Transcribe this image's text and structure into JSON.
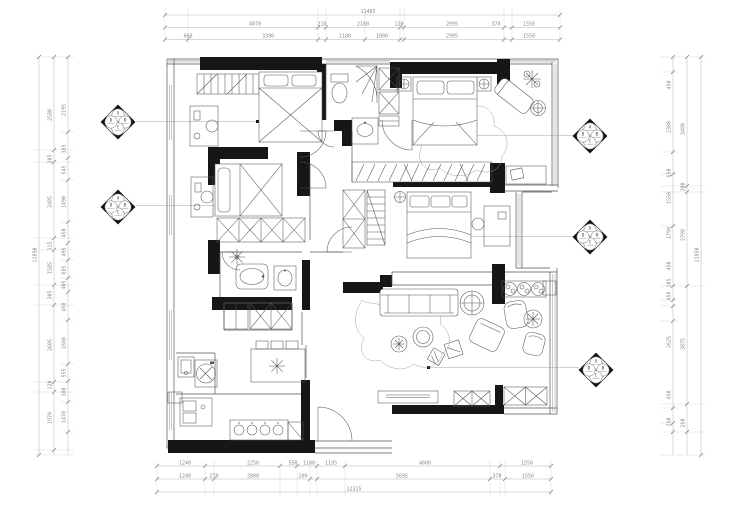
{
  "title": "apartment-floor-plan",
  "colors": {
    "wall": "#161616",
    "furniture_line": "#555555",
    "dim_text": "#8a8a8a",
    "dim_line": "#b5b5b5",
    "background": "#ffffff"
  },
  "dims": {
    "top_total": "11485",
    "top2": [
      "4070",
      "210",
      "2180",
      "110",
      "2995",
      "370",
      "1550"
    ],
    "top3": [
      "660",
      "3390",
      "1180",
      "1000",
      "2995",
      "1550"
    ],
    "bottom1": [
      "1240",
      "2250",
      "550",
      "1100",
      "1195",
      "4600",
      "1550"
    ],
    "bottom2": [
      "1240",
      "270",
      "2800",
      "200",
      "5695",
      "370",
      "1550"
    ],
    "bottom_total": "12325",
    "left_total": "11850",
    "left_outer": [
      "2580",
      "205",
      "2485",
      "115",
      "1585",
      "305",
      "2605",
      "120",
      "1970"
    ],
    "left_inner": [
      "2195",
      "385",
      "545",
      "1490",
      "450",
      "495",
      "685",
      "405",
      "450",
      "1680",
      "555",
      "380",
      "1470"
    ],
    "right_total": "11850",
    "right_outer": [
      "3480",
      "300",
      "2790",
      "3875",
      "260"
    ],
    "right_inner": [
      "450",
      "2380",
      "650",
      "1550",
      "1790",
      "450",
      "105",
      "450",
      "2625",
      "450",
      "250"
    ]
  },
  "markers": {
    "letters": {
      "top": "A",
      "right": "B",
      "bottom": "C",
      "left": "D"
    }
  }
}
